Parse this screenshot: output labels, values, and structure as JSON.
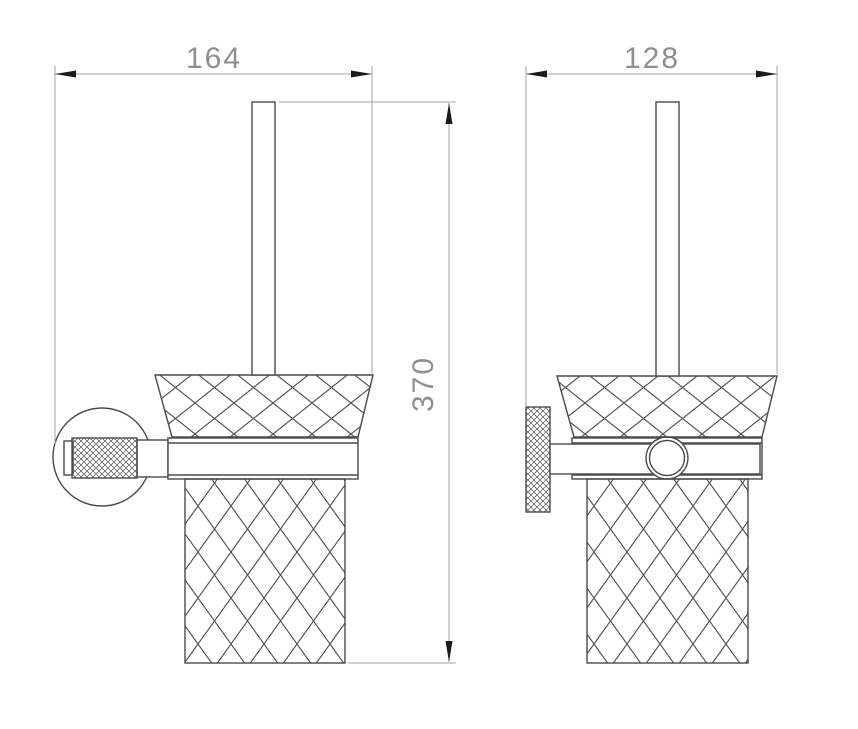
{
  "drawing": {
    "kind": "technical-dimension-drawing",
    "views": {
      "front": {
        "width_dim": "164",
        "height_dim": "370"
      },
      "side": {
        "width_dim": "128"
      }
    },
    "colors": {
      "background": "#ffffff",
      "outline": "#4a4a4a",
      "pattern_line": "#4f4f4f",
      "dimension_line": "#a6a6a6",
      "dimension_text": "#8f8f8f",
      "arrowhead": "#1a1a1a"
    }
  }
}
